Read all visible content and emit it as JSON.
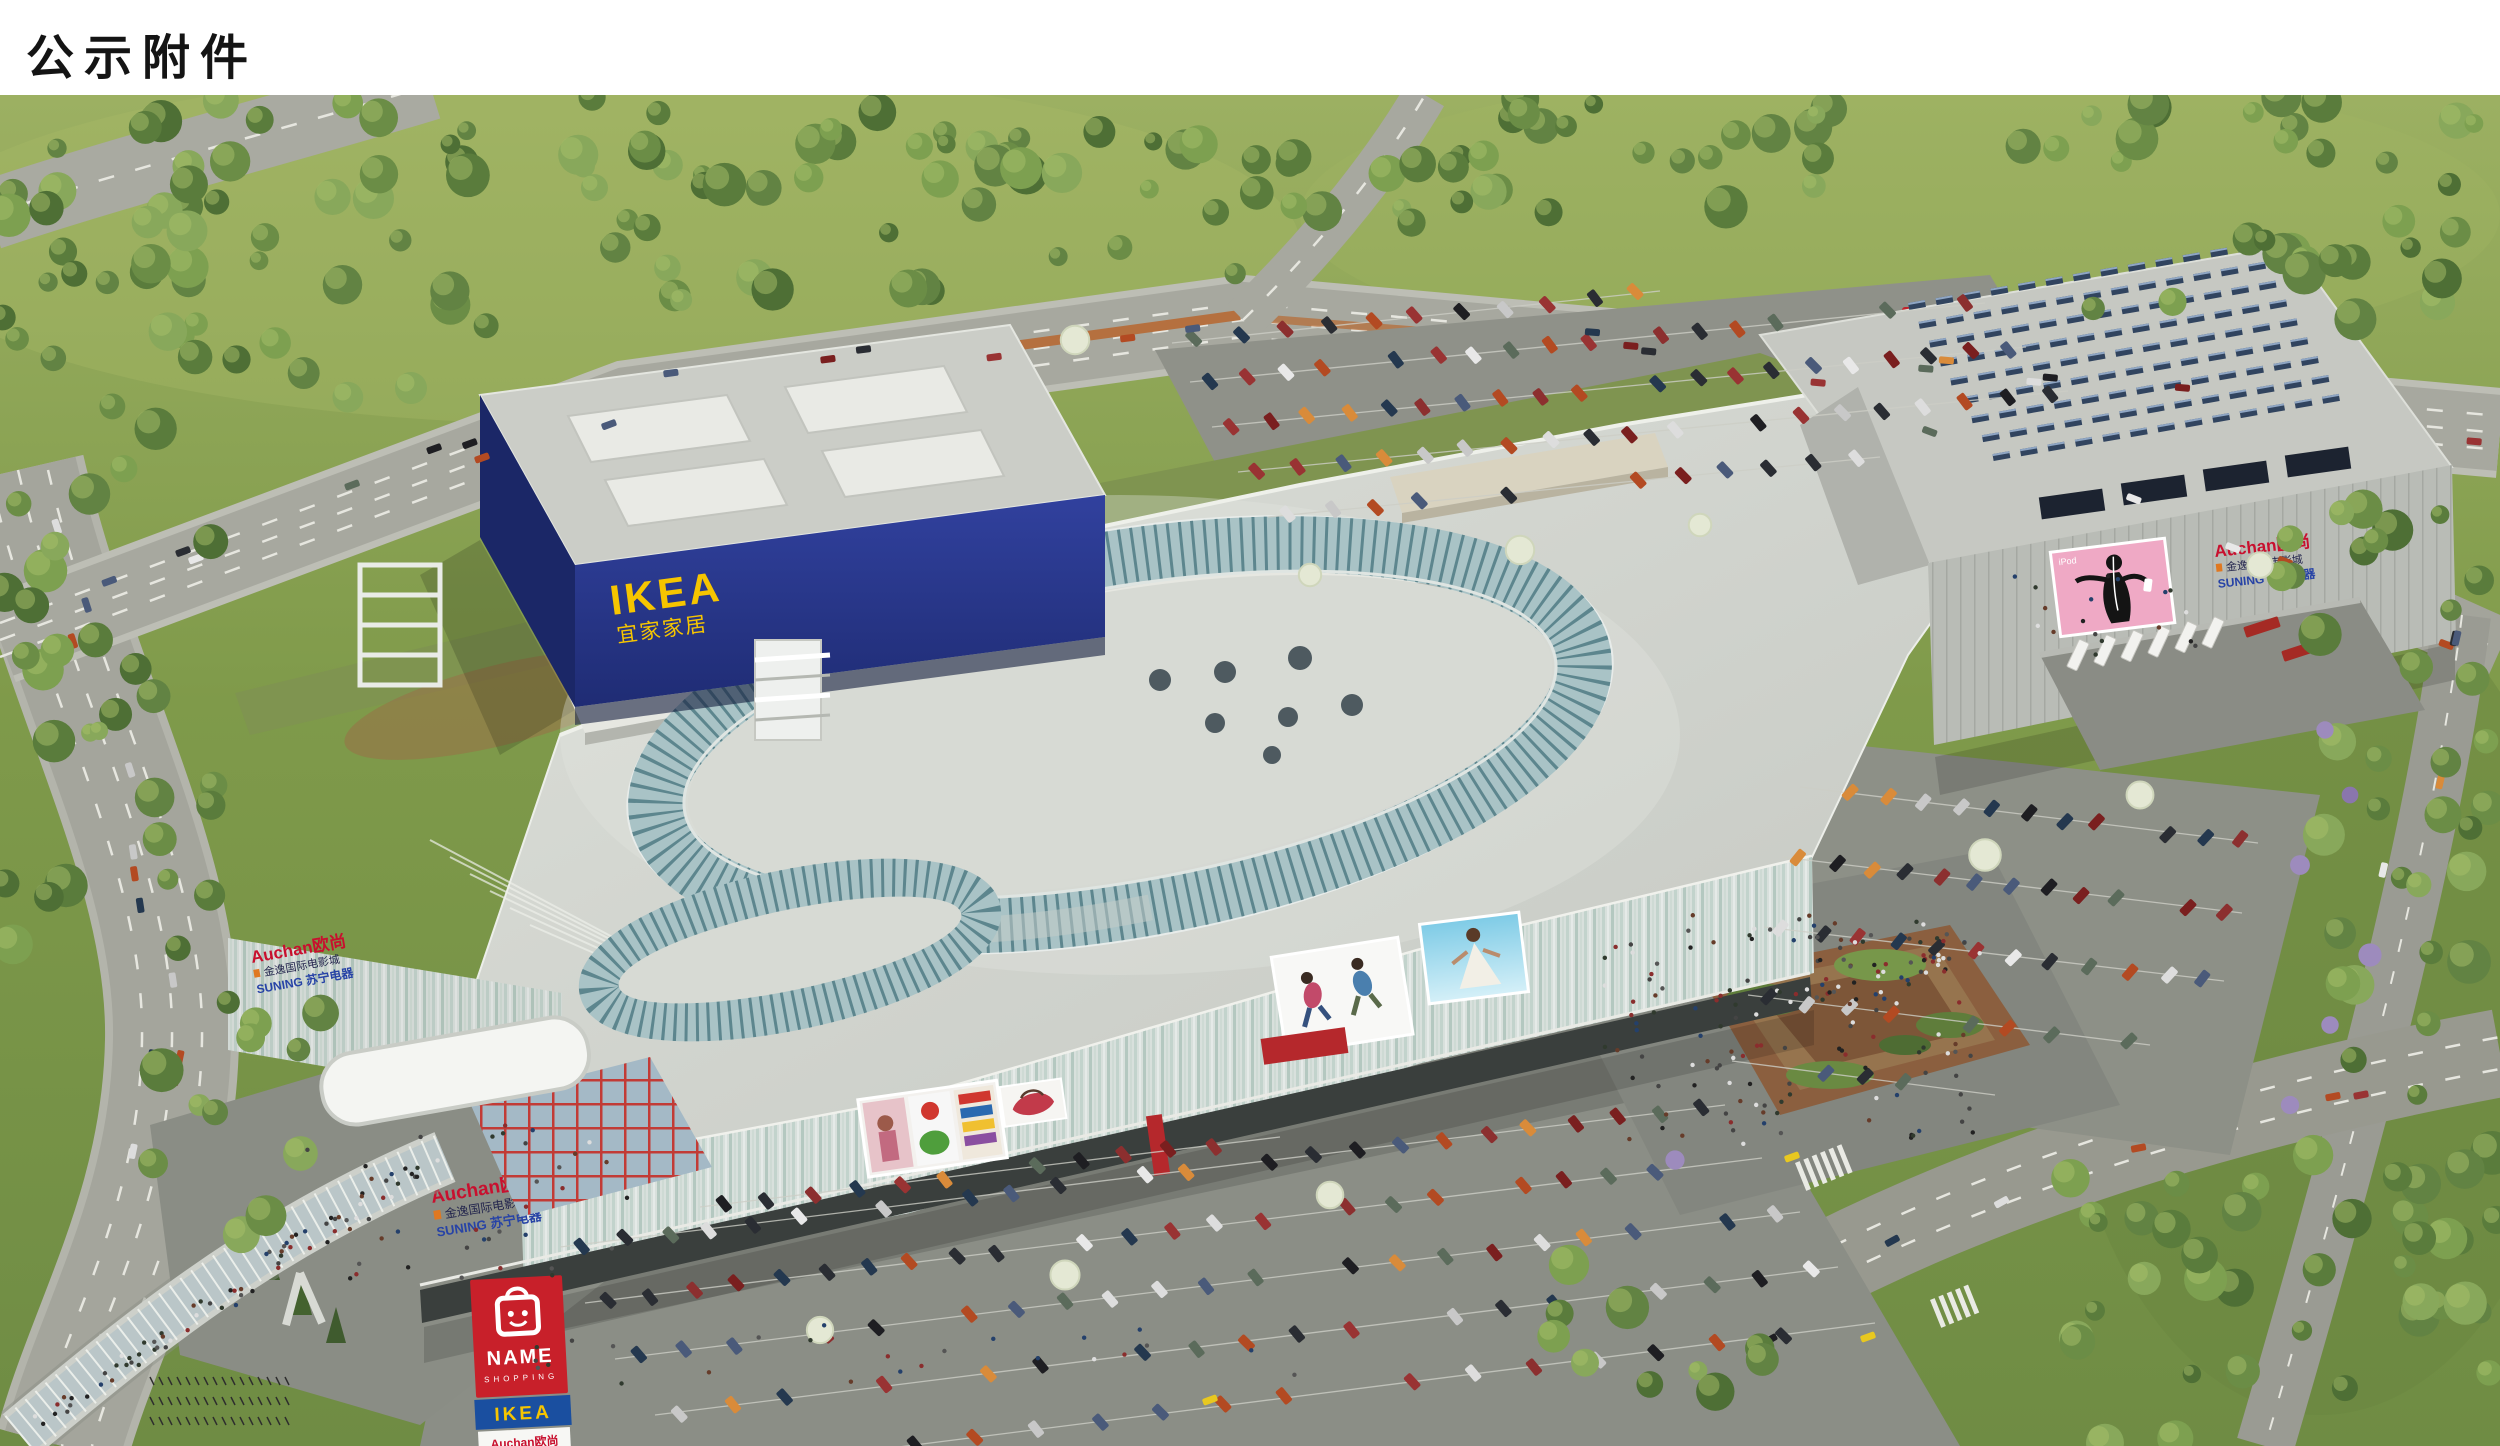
{
  "header": {
    "title": "公示附件"
  },
  "ikea_store": {
    "sign_en": "IKEA",
    "sign_cn": "宜家家居"
  },
  "mall": {
    "west_signage": {
      "line1": "Auchan欧尚",
      "line2": "金逸国际电影城",
      "line3": "SUNING 苏宁电器"
    },
    "south_signage": {
      "line1": "Auchan欧尚",
      "line2": "金逸国际电影城",
      "line3": "SUNING 苏宁电器"
    },
    "east_signage": {
      "line1": "Auchan欧尚",
      "line2": "金逸国际电影城",
      "line3": "SUNING 苏宁电器"
    },
    "ipod_billboard_label": "iPod"
  },
  "pylon_sign": {
    "brand": "NAME",
    "brand_sub": "SHOPPING",
    "tenant1": "IKEA",
    "tenant2": "Auchan欧尚",
    "tenant3": "金逸国际电影城",
    "tenant4": "SUNING 苏宁电器"
  },
  "colors": {
    "ikea_blue": "#26368c",
    "ikea_yellow": "#f6c500",
    "auchan_red": "#c8102e",
    "suning_blue": "#2743a6",
    "mall_accent_red": "#b5282c",
    "billboard_pink": "#efa9c5",
    "roof_teal": "#73989f"
  }
}
